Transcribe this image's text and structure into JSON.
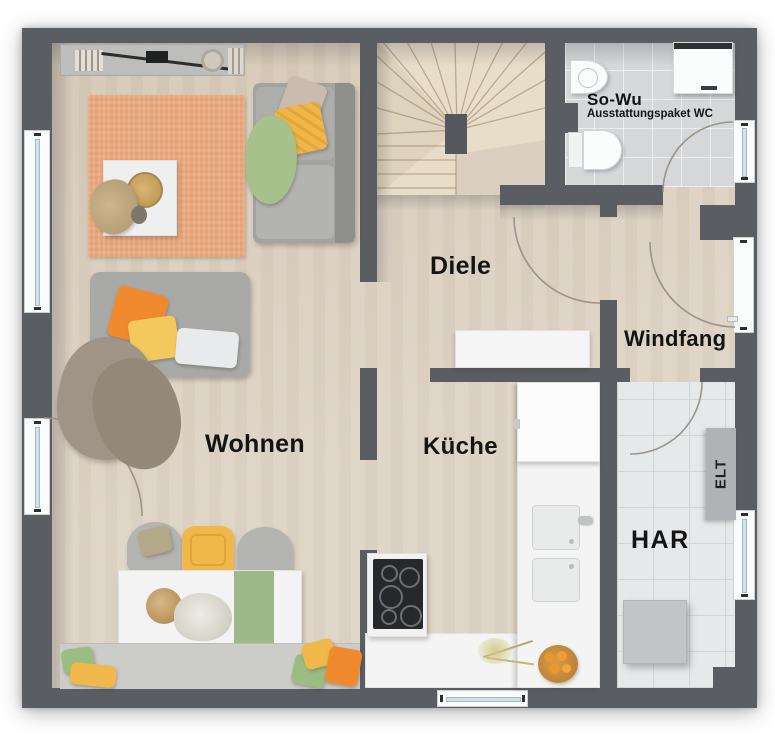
{
  "rooms": {
    "wohnen": {
      "label": "Wohnen"
    },
    "diele": {
      "label": "Diele"
    },
    "kueche": {
      "label": "Küche"
    },
    "windfang": {
      "label": "Windfang"
    },
    "har": {
      "label": "HAR"
    },
    "wc": {
      "label": "So-Wu",
      "subtitle": "Ausstattungspaket WC"
    }
  },
  "annotations": {
    "elt_panel": "ELT"
  },
  "palette": {
    "wall": "#5a5e62",
    "wood_floor": "#ddd2c2",
    "tile_wc": "#d5d7d9",
    "tile_har": "#e7e8e9",
    "stair": "#e8ddc8",
    "rug": "#e9a87e",
    "counter_white": "#f3f4f3",
    "accent_orange": "#ef8b2e",
    "accent_yellow": "#f0b84a",
    "accent_green": "#9cbd82"
  }
}
